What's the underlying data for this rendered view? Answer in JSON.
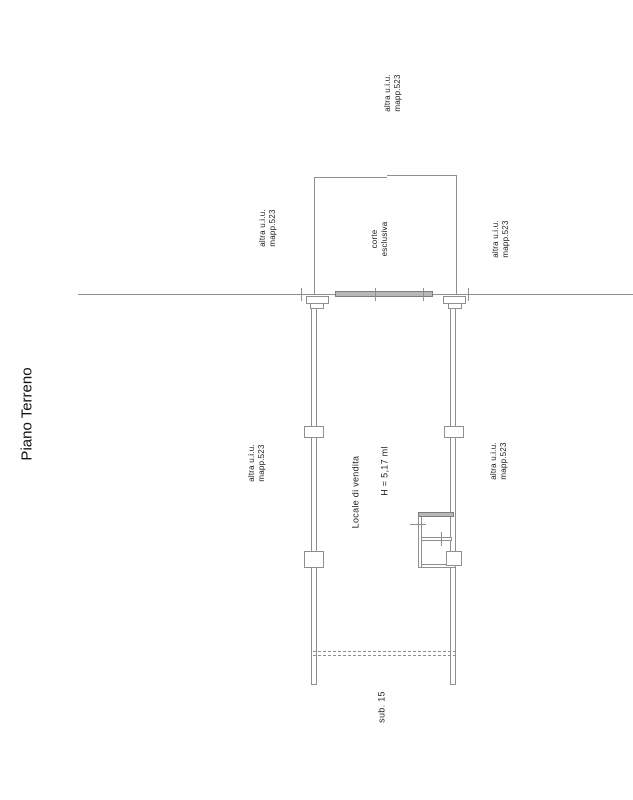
{
  "page": {
    "floor_title": "Piano Terreno"
  },
  "plan": {
    "labels": {
      "adjacent_unit_line1": "altra u.i.u.",
      "adjacent_unit_line2": "mapp.523",
      "courtyard_line1": "corte",
      "courtyard_line2": "esclusiva",
      "sales_room": "Locale di vendita",
      "ceiling_height": "H = 5,17 ml",
      "subunit": "sub. 15"
    },
    "colors": {
      "line": "#8f8f8f",
      "glass_fill": "#b8b8b8",
      "glass_border": "#7d7d7d",
      "text": "#1f1f1f",
      "background": "#ffffff"
    }
  }
}
